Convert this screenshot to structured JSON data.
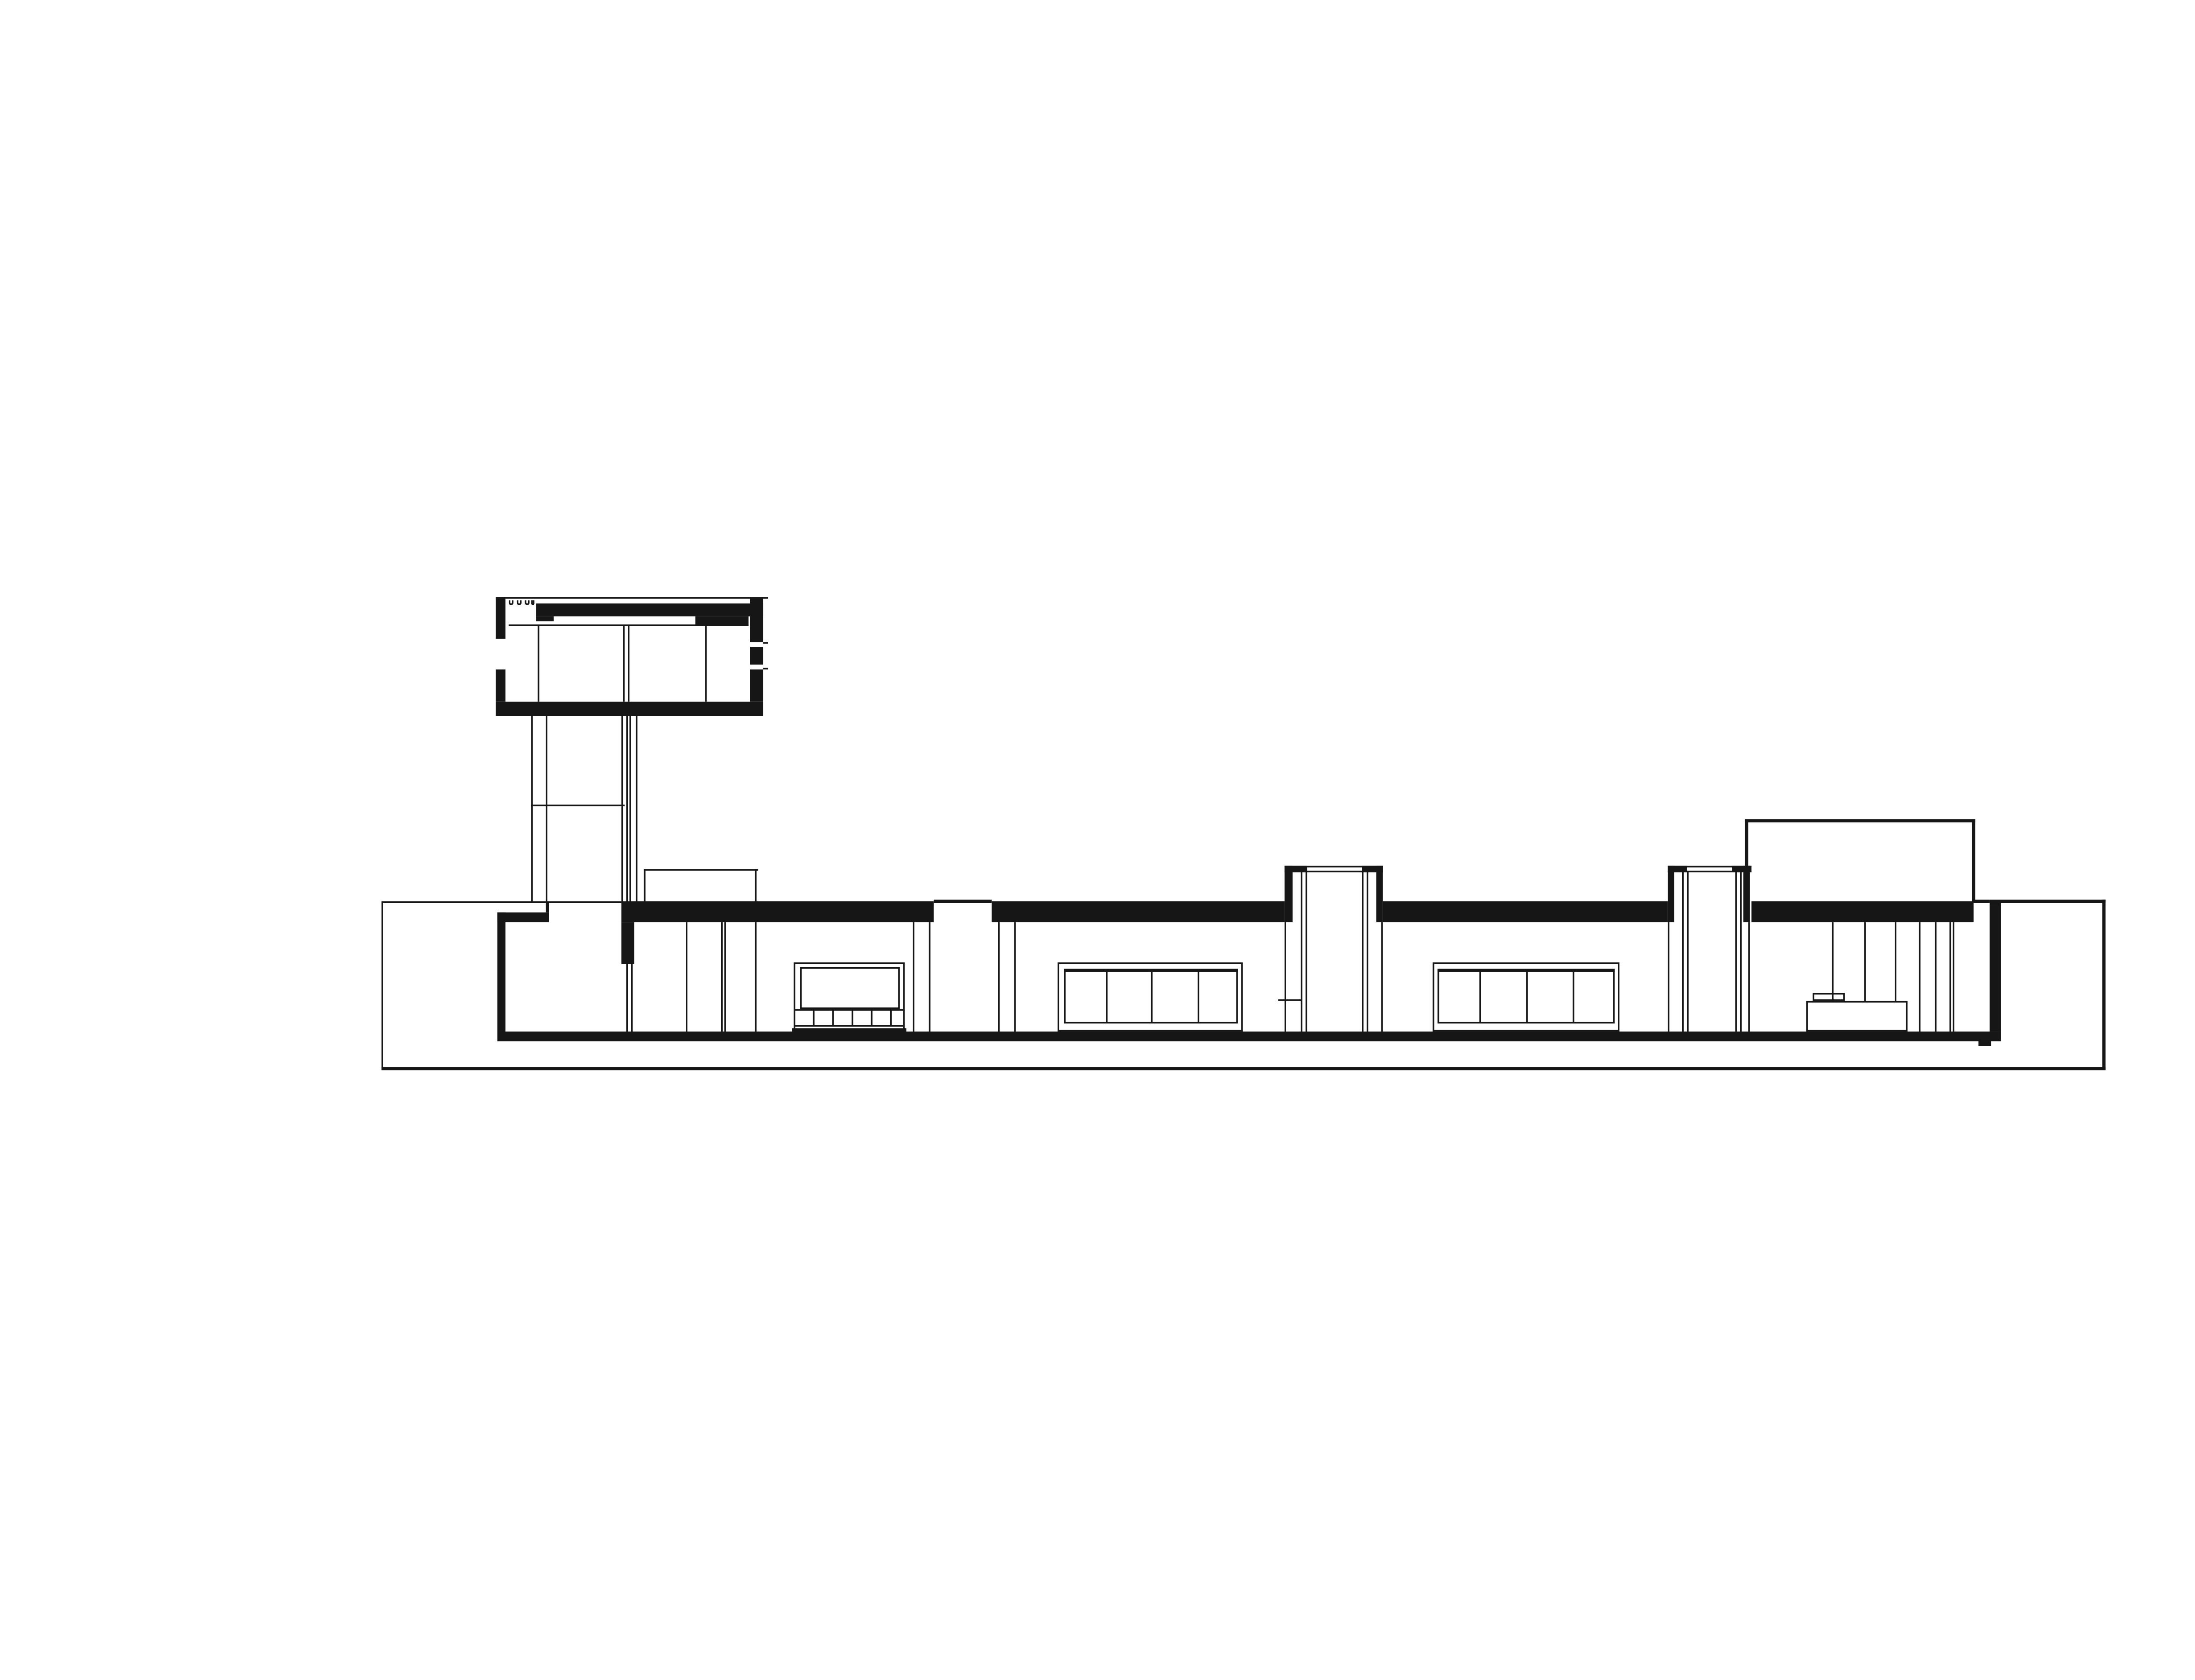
{
  "drawing": {
    "palette": {
      "paper": "#ffffff",
      "ink": "#161616"
    },
    "canvas": {
      "design_width": 1546,
      "design_height": 1044,
      "scale": 3.6669
    },
    "elements": [
      {
        "name": "terrace-line-left",
        "kind": "fill",
        "x": 237.0,
        "y": 559.8,
        "w": 149.3,
        "h": 1.6
      },
      {
        "name": "roofline-over-slot",
        "kind": "fill",
        "x": 580.3,
        "y": 559.2,
        "w": 35.5,
        "h": 1.5
      },
      {
        "name": "roofline-right-thin",
        "kind": "fill",
        "x": 1226.0,
        "y": 559.2,
        "w": 10.0,
        "h": 1.5
      },
      {
        "name": "courtyard-wall-top",
        "kind": "fill",
        "x": 1236.0,
        "y": 559.2,
        "w": 72.0,
        "h": 1.8
      },
      {
        "name": "plinth-edge-left",
        "kind": "fill",
        "x": 237.0,
        "y": 559.8,
        "w": 1.4,
        "h": 105.4
      },
      {
        "name": "plinth-bottom-line",
        "kind": "fill",
        "x": 237.0,
        "y": 663.2,
        "w": 1071.0,
        "h": 2.3
      },
      {
        "name": "courtyard-wall-right",
        "kind": "fill",
        "x": 1305.8,
        "y": 559.2,
        "w": 2.6,
        "h": 106.3
      },
      {
        "name": "roof-slab-segment-1",
        "kind": "fill",
        "x": 386.3,
        "y": 559.8,
        "w": 194.0,
        "h": 12.8
      },
      {
        "name": "roof-slab-segment-2",
        "kind": "fill",
        "x": 615.8,
        "y": 559.8,
        "w": 182.2,
        "h": 12.8
      },
      {
        "name": "roof-slab-segment-3",
        "kind": "fill",
        "x": 859.0,
        "y": 559.8,
        "w": 177.0,
        "h": 12.8
      },
      {
        "name": "roof-slab-segment-4",
        "kind": "fill",
        "x": 1088.0,
        "y": 559.8,
        "w": 138.0,
        "h": 12.8
      },
      {
        "name": "left-bay-roof-band",
        "kind": "fill",
        "x": 308.9,
        "y": 567.0,
        "w": 32.5,
        "h": 5.7
      },
      {
        "name": "left-bay-roof-step",
        "kind": "fill",
        "x": 338.9,
        "y": 559.8,
        "w": 2.5,
        "h": 7.4
      },
      {
        "name": "exterior-wall-left",
        "kind": "fill",
        "x": 308.9,
        "y": 567.0,
        "w": 4.7,
        "h": 74.0
      },
      {
        "name": "entrance-lintel-wall",
        "kind": "fill",
        "x": 386.3,
        "y": 572.6,
        "w": 8.2,
        "h": 26.4
      },
      {
        "name": "entrance-door-line-a",
        "kind": "fill",
        "x": 389.1,
        "y": 599.0,
        "w": 1.1,
        "h": 42.0
      },
      {
        "name": "entrance-door-line-b",
        "kind": "fill",
        "x": 391.8,
        "y": 599.0,
        "w": 1.1,
        "h": 42.0
      },
      {
        "name": "floor-slab",
        "kind": "fill",
        "x": 308.9,
        "y": 641.0,
        "w": 934.3,
        "h": 5.6
      },
      {
        "name": "floor-foundation-step",
        "kind": "fill",
        "x": 1229.0,
        "y": 646.5,
        "w": 8.4,
        "h": 3.0
      },
      {
        "name": "tower-roof-top-line",
        "kind": "fill",
        "x": 307.9,
        "y": 370.9,
        "w": 169.2,
        "h": 1.5
      },
      {
        "name": "tower-wall-left-upper",
        "kind": "fill",
        "x": 307.9,
        "y": 372.4,
        "w": 5.8,
        "h": 24.8
      },
      {
        "name": "tower-wall-left-lower",
        "kind": "fill",
        "x": 307.9,
        "y": 416.0,
        "w": 5.8,
        "h": 20.4
      },
      {
        "name": "tower-joist-hook-icon",
        "kind": "outline-open-top",
        "x": 316.2,
        "y": 372.8,
        "w": 2.6,
        "h": 3.6,
        "stroke": 0.9
      },
      {
        "name": "tower-joist-hook-icon",
        "kind": "outline-open-top",
        "x": 321.3,
        "y": 372.8,
        "w": 2.6,
        "h": 3.6,
        "stroke": 0.9
      },
      {
        "name": "tower-joist-hook-icon",
        "kind": "outline-open-top",
        "x": 326.4,
        "y": 372.8,
        "w": 2.6,
        "h": 3.6,
        "stroke": 0.9
      },
      {
        "name": "tower-joist-hook-icon",
        "kind": "outline-open-top",
        "x": 329.9,
        "y": 372.8,
        "w": 2.6,
        "h": 3.6,
        "stroke": 0.9
      },
      {
        "name": "tower-roof-band",
        "kind": "fill",
        "x": 333.3,
        "y": 375.4,
        "w": 140.7,
        "h": 7.3
      },
      {
        "name": "tower-roof-band-foot",
        "kind": "fill",
        "x": 333.3,
        "y": 382.7,
        "w": 11.0,
        "h": 3.2
      },
      {
        "name": "tower-clerestory-strip",
        "kind": "white",
        "x": 344.3,
        "y": 382.7,
        "w": 87.4,
        "h": 2.1
      },
      {
        "name": "tower-roof-band-deep",
        "kind": "fill",
        "x": 431.7,
        "y": 382.7,
        "w": 33.8,
        "h": 6.3
      },
      {
        "name": "tower-ceiling-line",
        "kind": "fill",
        "x": 315.8,
        "y": 387.8,
        "w": 149.7,
        "h": 1.2
      },
      {
        "name": "tower-partition-line",
        "kind": "fill",
        "x": 333.5,
        "y": 389.0,
        "w": 1.2,
        "h": 47.4
      },
      {
        "name": "tower-core-line-a",
        "kind": "fill",
        "x": 386.7,
        "y": 389.0,
        "w": 1.1,
        "h": 47.4
      },
      {
        "name": "tower-core-line-b",
        "kind": "fill",
        "x": 390.0,
        "y": 389.0,
        "w": 1.1,
        "h": 47.4
      },
      {
        "name": "tower-partition-line-2",
        "kind": "fill",
        "x": 438.0,
        "y": 389.0,
        "w": 1.2,
        "h": 47.4
      },
      {
        "name": "tower-floor-slab",
        "kind": "fill",
        "x": 307.9,
        "y": 436.4,
        "w": 166.1,
        "h": 8.2
      },
      {
        "name": "tower-wall-right-upper",
        "kind": "fill",
        "x": 465.5,
        "y": 372.4,
        "w": 8.5,
        "h": 26.6
      },
      {
        "name": "tower-wall-right-mid",
        "kind": "fill",
        "x": 465.5,
        "y": 402.0,
        "w": 8.5,
        "h": 11.0
      },
      {
        "name": "tower-wall-right-lower",
        "kind": "fill",
        "x": 465.5,
        "y": 416.0,
        "w": 8.5,
        "h": 20.4
      },
      {
        "name": "tower-window-nib-upper",
        "kind": "fill",
        "x": 474.0,
        "y": 398.8,
        "w": 3.2,
        "h": 1.4
      },
      {
        "name": "tower-window-nib-lower",
        "kind": "fill",
        "x": 474.0,
        "y": 414.6,
        "w": 3.2,
        "h": 1.4
      },
      {
        "name": "stair-shaft-line-1",
        "kind": "fill",
        "x": 330.0,
        "y": 444.6,
        "w": 1.2,
        "h": 115.2
      },
      {
        "name": "stair-shaft-line-2",
        "kind": "fill",
        "x": 338.6,
        "y": 444.6,
        "w": 1.2,
        "h": 115.2
      },
      {
        "name": "stair-shaft-landing",
        "kind": "fill",
        "x": 330.0,
        "y": 500.0,
        "w": 58.0,
        "h": 1.2
      },
      {
        "name": "stair-shaft-core-1",
        "kind": "fill",
        "x": 386.2,
        "y": 444.6,
        "w": 1.2,
        "h": 115.2
      },
      {
        "name": "stair-shaft-core-2",
        "kind": "fill",
        "x": 389.1,
        "y": 444.6,
        "w": 1.0,
        "h": 115.2
      },
      {
        "name": "stair-shaft-core-3",
        "kind": "fill",
        "x": 391.3,
        "y": 444.6,
        "w": 1.0,
        "h": 115.2
      },
      {
        "name": "stair-shaft-core-4",
        "kind": "fill",
        "x": 394.6,
        "y": 444.6,
        "w": 1.2,
        "h": 115.2
      },
      {
        "name": "roof-bulkhead-top",
        "kind": "fill",
        "x": 399.5,
        "y": 540.0,
        "w": 71.0,
        "h": 1.4
      },
      {
        "name": "roof-bulkhead-left",
        "kind": "fill",
        "x": 399.5,
        "y": 540.0,
        "w": 1.4,
        "h": 19.8
      },
      {
        "name": "roof-bulkhead-right",
        "kind": "fill",
        "x": 469.1,
        "y": 540.0,
        "w": 1.4,
        "h": 19.8
      },
      {
        "name": "patio-slot-wall-l1",
        "kind": "fill",
        "x": 566.5,
        "y": 572.6,
        "w": 1.2,
        "h": 68.4
      },
      {
        "name": "patio-slot-wall-l2",
        "kind": "fill",
        "x": 577.0,
        "y": 572.6,
        "w": 1.2,
        "h": 68.4
      },
      {
        "name": "patio-slot-wall-r1",
        "kind": "fill",
        "x": 619.5,
        "y": 572.6,
        "w": 1.2,
        "h": 68.4
      },
      {
        "name": "patio-slot-wall-r2",
        "kind": "fill",
        "x": 629.7,
        "y": 572.6,
        "w": 1.2,
        "h": 68.4
      },
      {
        "name": "interior-partition-a",
        "kind": "fill",
        "x": 426.0,
        "y": 572.6,
        "w": 1.1,
        "h": 68.4
      },
      {
        "name": "interior-partition-b1",
        "kind": "fill",
        "x": 447.8,
        "y": 572.6,
        "w": 1.1,
        "h": 68.4
      },
      {
        "name": "interior-partition-b2",
        "kind": "fill",
        "x": 449.9,
        "y": 572.6,
        "w": 1.1,
        "h": 68.4
      },
      {
        "name": "interior-partition-c",
        "kind": "fill",
        "x": 469.0,
        "y": 572.6,
        "w": 1.1,
        "h": 68.4
      },
      {
        "name": "window-1-frame",
        "kind": "outline",
        "x": 493.0,
        "y": 598.0,
        "w": 69.0,
        "h": 43.0,
        "stroke": 1.3
      },
      {
        "name": "window-1-pane",
        "kind": "outline",
        "x": 496.5,
        "y": 601.0,
        "w": 62.0,
        "h": 26.2,
        "stroke": 1.1
      },
      {
        "name": "window-1-sill-line",
        "kind": "fill",
        "x": 494.0,
        "y": 627.2,
        "w": 67.0,
        "h": 1.1
      },
      {
        "name": "window-1-sill-divider",
        "kind": "fill",
        "x": 505.0,
        "y": 627.2,
        "w": 1.1,
        "h": 10.1
      },
      {
        "name": "window-1-sill-divider",
        "kind": "fill",
        "x": 517.0,
        "y": 627.2,
        "w": 1.1,
        "h": 10.1
      },
      {
        "name": "window-1-sill-divider",
        "kind": "fill",
        "x": 529.0,
        "y": 627.2,
        "w": 1.1,
        "h": 10.1
      },
      {
        "name": "window-1-sill-divider",
        "kind": "fill",
        "x": 541.0,
        "y": 627.2,
        "w": 1.1,
        "h": 10.1
      },
      {
        "name": "window-1-sill-divider",
        "kind": "fill",
        "x": 553.0,
        "y": 627.2,
        "w": 1.1,
        "h": 10.1
      },
      {
        "name": "window-1-cabinet-base",
        "kind": "fill",
        "x": 494.0,
        "y": 637.3,
        "w": 67.0,
        "h": 1.2
      },
      {
        "name": "window-1-base-lip",
        "kind": "fill",
        "x": 492.0,
        "y": 638.8,
        "w": 71.0,
        "h": 1.8
      },
      {
        "name": "window-2-frame",
        "kind": "outline",
        "x": 657.0,
        "y": 598.0,
        "w": 115.0,
        "h": 43.0,
        "stroke": 1.4
      },
      {
        "name": "window-2-inner-frame",
        "kind": "outline",
        "x": 660.5,
        "y": 601.5,
        "w": 108.0,
        "h": 34.0,
        "stroke": 1.1
      },
      {
        "name": "window-2-head-bar",
        "kind": "fill",
        "x": 660.5,
        "y": 601.5,
        "w": 108.0,
        "h": 2.2
      },
      {
        "name": "window-2-mullion",
        "kind": "fill",
        "x": 686.5,
        "y": 603.7,
        "w": 1.2,
        "h": 31.8
      },
      {
        "name": "window-2-mullion",
        "kind": "fill",
        "x": 715.0,
        "y": 603.7,
        "w": 1.2,
        "h": 31.8
      },
      {
        "name": "window-2-mullion",
        "kind": "fill",
        "x": 743.5,
        "y": 603.7,
        "w": 1.2,
        "h": 31.8
      },
      {
        "name": "window-3-frame",
        "kind": "outline",
        "x": 889.6,
        "y": 598.0,
        "w": 116.5,
        "h": 43.0,
        "stroke": 1.4
      },
      {
        "name": "window-3-inner-frame",
        "kind": "outline",
        "x": 893.0,
        "y": 601.5,
        "w": 109.6,
        "h": 34.0,
        "stroke": 1.1
      },
      {
        "name": "window-3-head-bar",
        "kind": "fill",
        "x": 893.0,
        "y": 601.5,
        "w": 109.6,
        "h": 2.2
      },
      {
        "name": "window-3-mullion",
        "kind": "fill",
        "x": 918.8,
        "y": 603.7,
        "w": 1.2,
        "h": 31.8
      },
      {
        "name": "window-3-mullion",
        "kind": "fill",
        "x": 947.8,
        "y": 603.7,
        "w": 1.2,
        "h": 31.8
      },
      {
        "name": "window-3-mullion",
        "kind": "fill",
        "x": 976.8,
        "y": 603.7,
        "w": 1.2,
        "h": 31.8
      },
      {
        "name": "roof-block-1-cap-line-1",
        "kind": "fill",
        "x": 798.3,
        "y": 538.1,
        "w": 60.4,
        "h": 1.2
      },
      {
        "name": "roof-block-1-cap-line-2",
        "kind": "fill",
        "x": 798.3,
        "y": 540.6,
        "w": 60.4,
        "h": 1.1
      },
      {
        "name": "roof-block-1-cap-corner",
        "kind": "fill",
        "x": 798.3,
        "y": 537.6,
        "w": 13.4,
        "h": 4.0
      },
      {
        "name": "roof-block-1-cap-corner",
        "kind": "fill",
        "x": 845.8,
        "y": 537.6,
        "w": 13.4,
        "h": 4.0
      },
      {
        "name": "roof-block-1-bar-left",
        "kind": "fill",
        "x": 798.3,
        "y": 537.6,
        "w": 4.5,
        "h": 35.0
      },
      {
        "name": "roof-block-1-bar-right",
        "kind": "fill",
        "x": 854.7,
        "y": 537.6,
        "w": 4.5,
        "h": 35.0
      },
      {
        "name": "roof-block-1-wall-left",
        "kind": "fill",
        "x": 798.3,
        "y": 572.6,
        "w": 1.2,
        "h": 68.4
      },
      {
        "name": "roof-block-1-wall-right",
        "kind": "fill",
        "x": 858.0,
        "y": 572.6,
        "w": 1.2,
        "h": 68.4
      },
      {
        "name": "roof-block-1-core-l1",
        "kind": "fill",
        "x": 808.2,
        "y": 541.7,
        "w": 1.1,
        "h": 99.3
      },
      {
        "name": "roof-block-1-core-l2",
        "kind": "fill",
        "x": 811.2,
        "y": 541.7,
        "w": 1.1,
        "h": 99.3
      },
      {
        "name": "roof-block-1-core-r1",
        "kind": "fill",
        "x": 846.2,
        "y": 541.7,
        "w": 1.1,
        "h": 99.3
      },
      {
        "name": "roof-block-1-core-r2",
        "kind": "fill",
        "x": 849.2,
        "y": 541.7,
        "w": 1.1,
        "h": 99.3
      },
      {
        "name": "roof-block-1-shelf-tick",
        "kind": "fill",
        "x": 793.5,
        "y": 621.0,
        "w": 15.0,
        "h": 1.3
      },
      {
        "name": "roof-block-2-cap-line-1",
        "kind": "fill",
        "x": 1036.0,
        "y": 538.1,
        "w": 51.5,
        "h": 1.2
      },
      {
        "name": "roof-block-2-cap-line-2",
        "kind": "fill",
        "x": 1036.0,
        "y": 540.6,
        "w": 51.5,
        "h": 1.1
      },
      {
        "name": "roof-block-2-cap-corner",
        "kind": "fill",
        "x": 1036.0,
        "y": 537.6,
        "w": 12.0,
        "h": 4.0
      },
      {
        "name": "roof-block-2-cap-corner",
        "kind": "fill",
        "x": 1075.5,
        "y": 537.6,
        "w": 12.0,
        "h": 4.0
      },
      {
        "name": "roof-block-2-bar-left",
        "kind": "fill",
        "x": 1036.0,
        "y": 537.6,
        "w": 4.4,
        "h": 35.0
      },
      {
        "name": "roof-block-2-bar-right",
        "kind": "fill",
        "x": 1083.1,
        "y": 537.6,
        "w": 4.4,
        "h": 35.0
      },
      {
        "name": "roof-block-2-wall-left",
        "kind": "fill",
        "x": 1036.0,
        "y": 572.6,
        "w": 1.2,
        "h": 68.4
      },
      {
        "name": "roof-block-2-wall-right",
        "kind": "fill",
        "x": 1086.3,
        "y": 572.6,
        "w": 1.2,
        "h": 68.4
      },
      {
        "name": "roof-block-2-core-l1",
        "kind": "fill",
        "x": 1044.6,
        "y": 541.7,
        "w": 1.1,
        "h": 99.3
      },
      {
        "name": "roof-block-2-core-l2",
        "kind": "fill",
        "x": 1047.6,
        "y": 541.7,
        "w": 1.1,
        "h": 99.3
      },
      {
        "name": "roof-block-2-core-r1",
        "kind": "fill",
        "x": 1078.3,
        "y": 541.7,
        "w": 1.1,
        "h": 99.3
      },
      {
        "name": "roof-block-2-core-r2",
        "kind": "fill",
        "x": 1081.3,
        "y": 541.7,
        "w": 1.1,
        "h": 99.3
      },
      {
        "name": "upper-volume-top",
        "kind": "fill",
        "x": 1084.0,
        "y": 509.0,
        "w": 142.5,
        "h": 1.5
      },
      {
        "name": "upper-volume-left",
        "kind": "fill",
        "x": 1084.0,
        "y": 509.0,
        "w": 1.5,
        "h": 28.6
      },
      {
        "name": "upper-volume-right",
        "kind": "fill",
        "x": 1225.0,
        "y": 509.0,
        "w": 1.5,
        "h": 52.0
      },
      {
        "name": "right-room-line-1",
        "kind": "fill",
        "x": 1138.0,
        "y": 572.6,
        "w": 1.1,
        "h": 49.4
      },
      {
        "name": "right-room-line-2",
        "kind": "fill",
        "x": 1158.0,
        "y": 572.6,
        "w": 1.1,
        "h": 49.4
      },
      {
        "name": "right-room-line-3",
        "kind": "fill",
        "x": 1177.0,
        "y": 572.6,
        "w": 1.1,
        "h": 49.4
      },
      {
        "name": "right-room-line-4",
        "kind": "fill",
        "x": 1192.0,
        "y": 572.6,
        "w": 1.1,
        "h": 68.4
      },
      {
        "name": "right-room-line-5",
        "kind": "fill",
        "x": 1202.0,
        "y": 572.6,
        "w": 1.1,
        "h": 68.4
      },
      {
        "name": "right-room-line-6a",
        "kind": "fill",
        "x": 1210.5,
        "y": 572.6,
        "w": 1.1,
        "h": 68.4
      },
      {
        "name": "right-room-line-6b",
        "kind": "fill",
        "x": 1212.7,
        "y": 572.6,
        "w": 1.1,
        "h": 68.4
      },
      {
        "name": "bench",
        "kind": "outline",
        "x": 1122.0,
        "y": 622.0,
        "w": 63.0,
        "h": 19.0,
        "stroke": 1.3
      },
      {
        "name": "bench-top-box",
        "kind": "outline",
        "x": 1126.0,
        "y": 617.0,
        "w": 20.0,
        "h": 5.4,
        "stroke": 1.1
      },
      {
        "name": "exterior-wall-right",
        "kind": "fill",
        "x": 1236.0,
        "y": 561.0,
        "w": 7.2,
        "h": 80.0
      }
    ]
  }
}
